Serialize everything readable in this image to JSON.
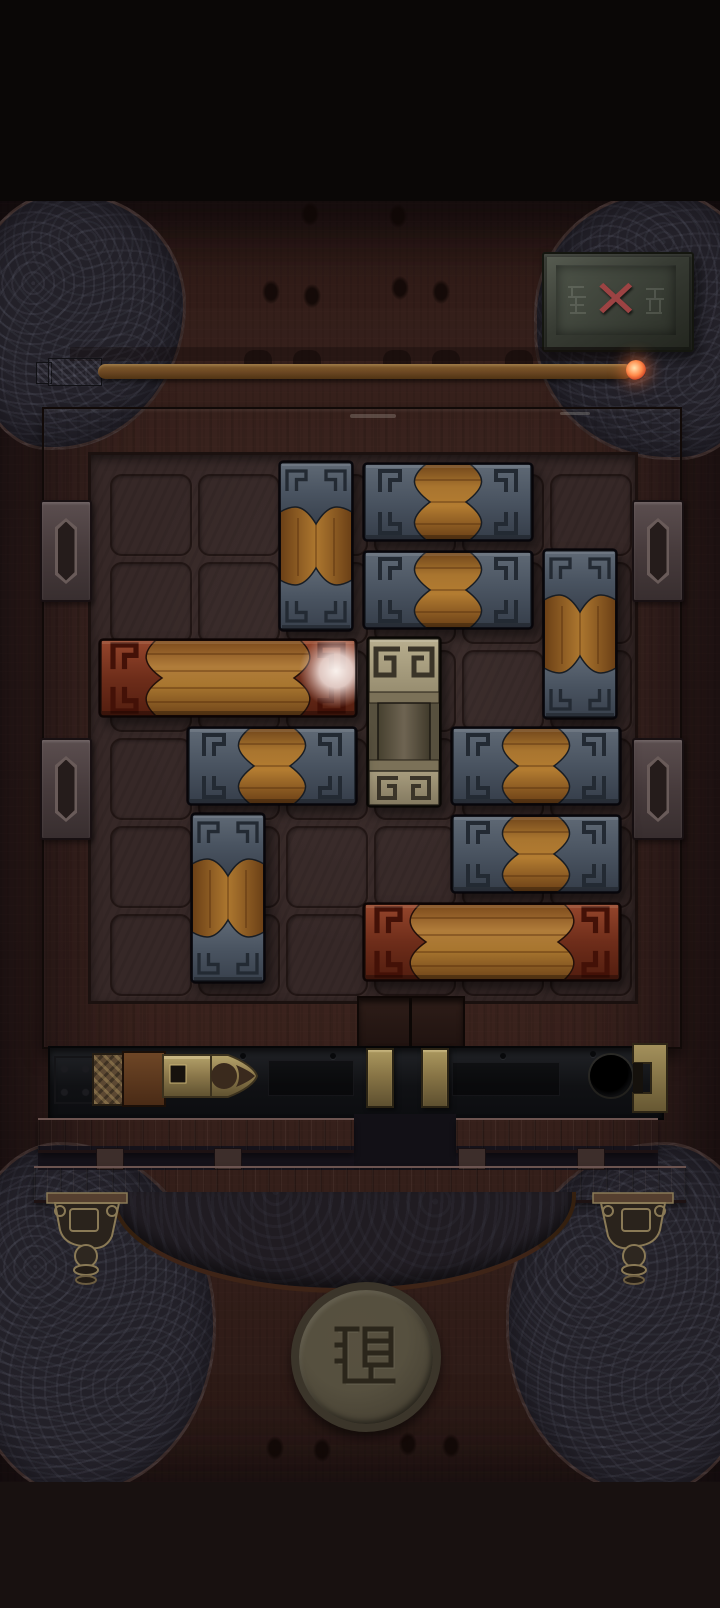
{
  "close_button": {
    "glyph": "✕",
    "x_color": "#9c4343"
  },
  "timer": {
    "kind": "incense-stick",
    "remaining_fraction": 0.97,
    "ember_color": "#ff8a4a",
    "stick_color": "#6b4722"
  },
  "board": {
    "grid": {
      "cols": 6,
      "rows": 6
    },
    "exit": {
      "side": "bottom",
      "col": 3,
      "width_cells": 1
    },
    "pieces": [
      {
        "id": "stone-v-1",
        "type": "stone_v",
        "col": 2,
        "row": 0,
        "w": 1,
        "h": 2
      },
      {
        "id": "stone-h-1",
        "type": "stone_h",
        "col": 3,
        "row": 0,
        "w": 2,
        "h": 1
      },
      {
        "id": "stone-h-2",
        "type": "stone_h",
        "col": 3,
        "row": 1,
        "w": 2,
        "h": 1
      },
      {
        "id": "stone-v-2",
        "type": "stone_v",
        "col": 5,
        "row": 1,
        "w": 1,
        "h": 2
      },
      {
        "id": "red-plank-1",
        "type": "red_h",
        "col": 0,
        "row": 2,
        "w": 3,
        "h": 1,
        "orb": true
      },
      {
        "id": "key-stone",
        "type": "key_v",
        "col": 3,
        "row": 2,
        "w": 1,
        "h": 2
      },
      {
        "id": "stone-h-3",
        "type": "stone_h",
        "col": 1,
        "row": 3,
        "w": 2,
        "h": 1
      },
      {
        "id": "stone-h-4",
        "type": "stone_h",
        "col": 4,
        "row": 3,
        "w": 2,
        "h": 1
      },
      {
        "id": "stone-v-3",
        "type": "stone_v",
        "col": 1,
        "row": 4,
        "w": 1,
        "h": 2
      },
      {
        "id": "stone-h-5",
        "type": "stone_h",
        "col": 4,
        "row": 4,
        "w": 2,
        "h": 1
      },
      {
        "id": "red-plank-2",
        "type": "red_h",
        "col": 3,
        "row": 5,
        "w": 3,
        "h": 1
      }
    ],
    "empty_cells": [
      [
        0,
        0
      ],
      [
        1,
        0
      ],
      [
        5,
        0
      ],
      [
        0,
        1
      ],
      [
        1,
        1
      ],
      [
        4,
        2
      ],
      [
        0,
        3
      ],
      [
        0,
        4
      ],
      [
        2,
        4
      ],
      [
        3,
        4
      ],
      [
        0,
        5
      ],
      [
        2,
        5
      ]
    ]
  },
  "orb": {
    "color": "#f6ece8",
    "piece": "red-plank-1",
    "cell": [
      2,
      2
    ]
  },
  "latch": {
    "state": "unlatched",
    "slider_side": "left",
    "brass_color": "#a89560"
  },
  "seal": {
    "glyph": "退"
  },
  "colors": {
    "stone_light": "#5f6975",
    "stone_dark": "#353d49",
    "wood_light": "#b37c31",
    "wood_dark": "#6a3f16",
    "red_light": "#8e4229",
    "red_dark": "#521d0f",
    "key_light": "#b8ae8e",
    "key_dark": "#857b60",
    "board_floor": "#362827",
    "frame_wood": "#3a2623",
    "track": "#17191c",
    "background_wood": "#3d2520",
    "carved_stone": "#232129"
  }
}
